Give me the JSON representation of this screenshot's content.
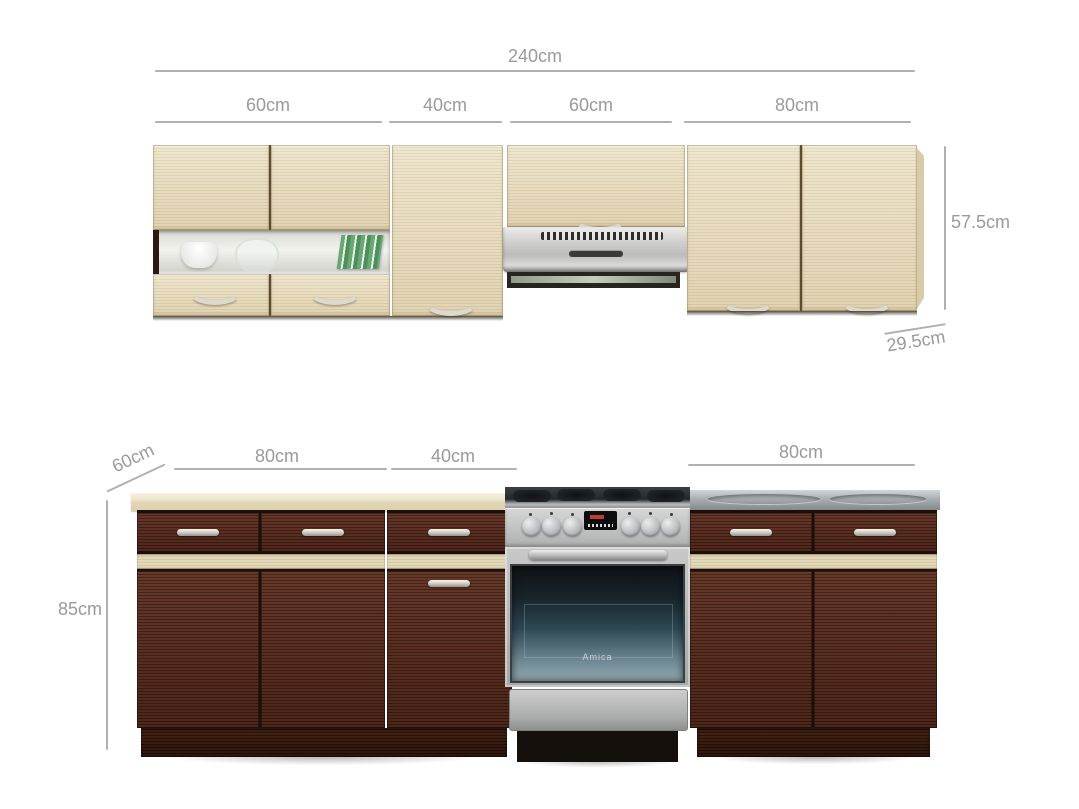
{
  "dimensions": {
    "upper": {
      "total": "240cm",
      "segments": [
        "60cm",
        "40cm",
        "60cm",
        "80cm"
      ],
      "height": "57.5cm",
      "depth": "29.5cm"
    },
    "lower": {
      "depth": "60cm",
      "segments": [
        "80cm",
        "40cm",
        "80cm"
      ],
      "height": "85cm"
    }
  },
  "cooker": {
    "brand": "Amica"
  },
  "colors": {
    "background": "#ffffff",
    "dimension_text": "#9a9a9a",
    "dimension_line": "#b0b0b0",
    "light_wood": "#e7dcbf",
    "dark_wood": "#53291d",
    "steel": "#b9bcbe"
  }
}
